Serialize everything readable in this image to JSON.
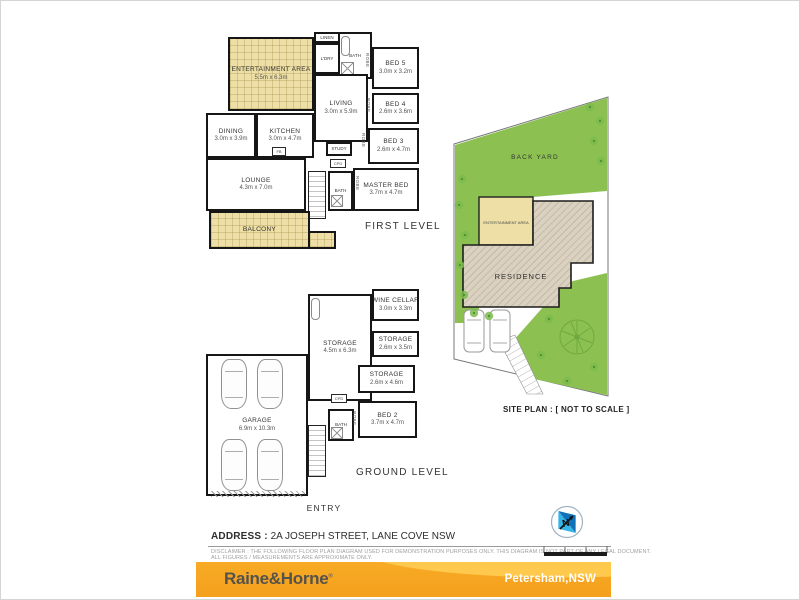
{
  "levels": {
    "first": {
      "title": "FIRST LEVEL",
      "rooms": {
        "entertainment": {
          "name": "ENTERTAINMENT AREA",
          "dims": "5.5m x 6.3m"
        },
        "bed5": {
          "name": "BED 5",
          "dims": "3.0m x 3.2m"
        },
        "living": {
          "name": "LIVING",
          "dims": "3.0m x 5.9m"
        },
        "bed4": {
          "name": "BED 4",
          "dims": "2.6m x 3.6m"
        },
        "dining": {
          "name": "DINING",
          "dims": "3.0m x 3.9m"
        },
        "kitchen": {
          "name": "KITCHEN",
          "dims": "3.0m x 4.7m"
        },
        "bed3": {
          "name": "BED 3",
          "dims": "2.6m x 4.7m"
        },
        "lounge": {
          "name": "LOUNGE",
          "dims": "4.3m x 7.0m"
        },
        "master": {
          "name": "MASTER BED",
          "dims": "3.7m x 4.7m"
        },
        "balcony": {
          "name": "BALCONY"
        }
      }
    },
    "ground": {
      "title": "GROUND LEVEL",
      "rooms": {
        "garage": {
          "name": "GARAGE",
          "dims": "6.9m x 10.3m"
        },
        "storage_main": {
          "name": "STORAGE",
          "dims": "4.5m x 6.3m"
        },
        "wine_cellar": {
          "name": "WINE CELLAR",
          "dims": "3.0m x 3.3m"
        },
        "storage2": {
          "name": "STORAGE",
          "dims": "2.6m x 3.5m"
        },
        "storage3": {
          "name": "STORAGE",
          "dims": "2.6m x 4.6m"
        },
        "bed2": {
          "name": "BED 2",
          "dims": "3.7m x 4.7m"
        }
      }
    }
  },
  "labels": {
    "robe": "ROBE",
    "linen": "LINEN",
    "laundry": "L'DRY",
    "bath": "BATH",
    "study": "STUDY",
    "cupboard": "CPD",
    "fb": "FB",
    "entry": "ENTRY"
  },
  "site_plan": {
    "back_yard": "BACK YARD",
    "entertainment": "ENTERTAINMENT AREA",
    "residence": "RESIDENCE",
    "caption": "SITE PLAN : [ NOT TO SCALE ]"
  },
  "footer": {
    "address_label": "ADDRESS :",
    "address": "2A JOSEPH STREET, LANE COVE  NSW",
    "disclaimer_line1": "DISCLAIMER : THE FOLLOWING FLOOR PLAN DIAGRAM USED FOR DEMONSTRATION PURPOSES ONLY. THIS DIAGRAM IS NOT PART OF ANY LEGAL DOCUMENT.",
    "disclaimer_line2": "ALL FIGURES / MEASUREMENTS ARE APPROXIMATE ONLY.",
    "brand": "Raine&Horne",
    "brand_mark": "®",
    "office": "Petersham,NSW",
    "north_icon": "north-compass",
    "colors": {
      "banner_yellow": "#F5A41E",
      "floor_tan": "#EDDFA5",
      "yard_green": "#8CC152",
      "wall_black": "#161616"
    }
  }
}
